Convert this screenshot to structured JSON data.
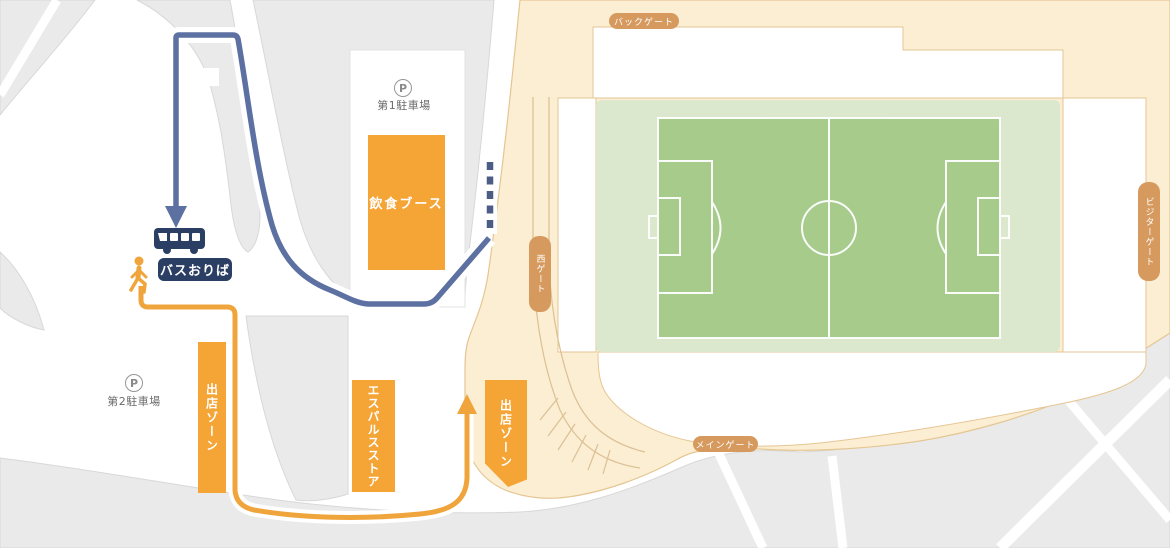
{
  "gates": {
    "back": {
      "label": "バックゲート"
    },
    "west": {
      "label": "西ゲート"
    },
    "visitor": {
      "label": "ビジターゲート"
    },
    "main": {
      "label": "メインゲート"
    }
  },
  "parking_lots": {
    "lot1": {
      "icon": "P",
      "label": "第1駐車場"
    },
    "lot2": {
      "icon": "P",
      "label": "第2駐車場"
    }
  },
  "facilities": {
    "food_booth": {
      "label": "飲食ブース"
    },
    "vendor_zone_west": {
      "label": "出店ゾーン"
    },
    "spulse_store": {
      "label": "エスパルスストア"
    },
    "vendor_zone_east": {
      "label": "出店ゾーン"
    }
  },
  "bus_stop": {
    "label": "バスおりば"
  },
  "icons": {
    "bus": "bus-icon",
    "walker": "walking-person-icon",
    "bus_route_arrow": "arrow-down-icon",
    "walk_route_arrow": "arrow-up-icon"
  },
  "colors": {
    "beige": "#fbeed3",
    "beige_line": "#e5c693",
    "gray_block": "#eaeaeb",
    "gray_line": "#d8d8d9",
    "orange_box": "#f5a436",
    "navy": "#2b3e63",
    "bus_route": "#5c70a1",
    "bus_route_dashed": "#4b5d85",
    "walk_route": "#f0a53c",
    "gate_pill": "#d69a5e",
    "pitch_surround": "#dbe8ce",
    "pitch_field": "#a6cb8b"
  }
}
